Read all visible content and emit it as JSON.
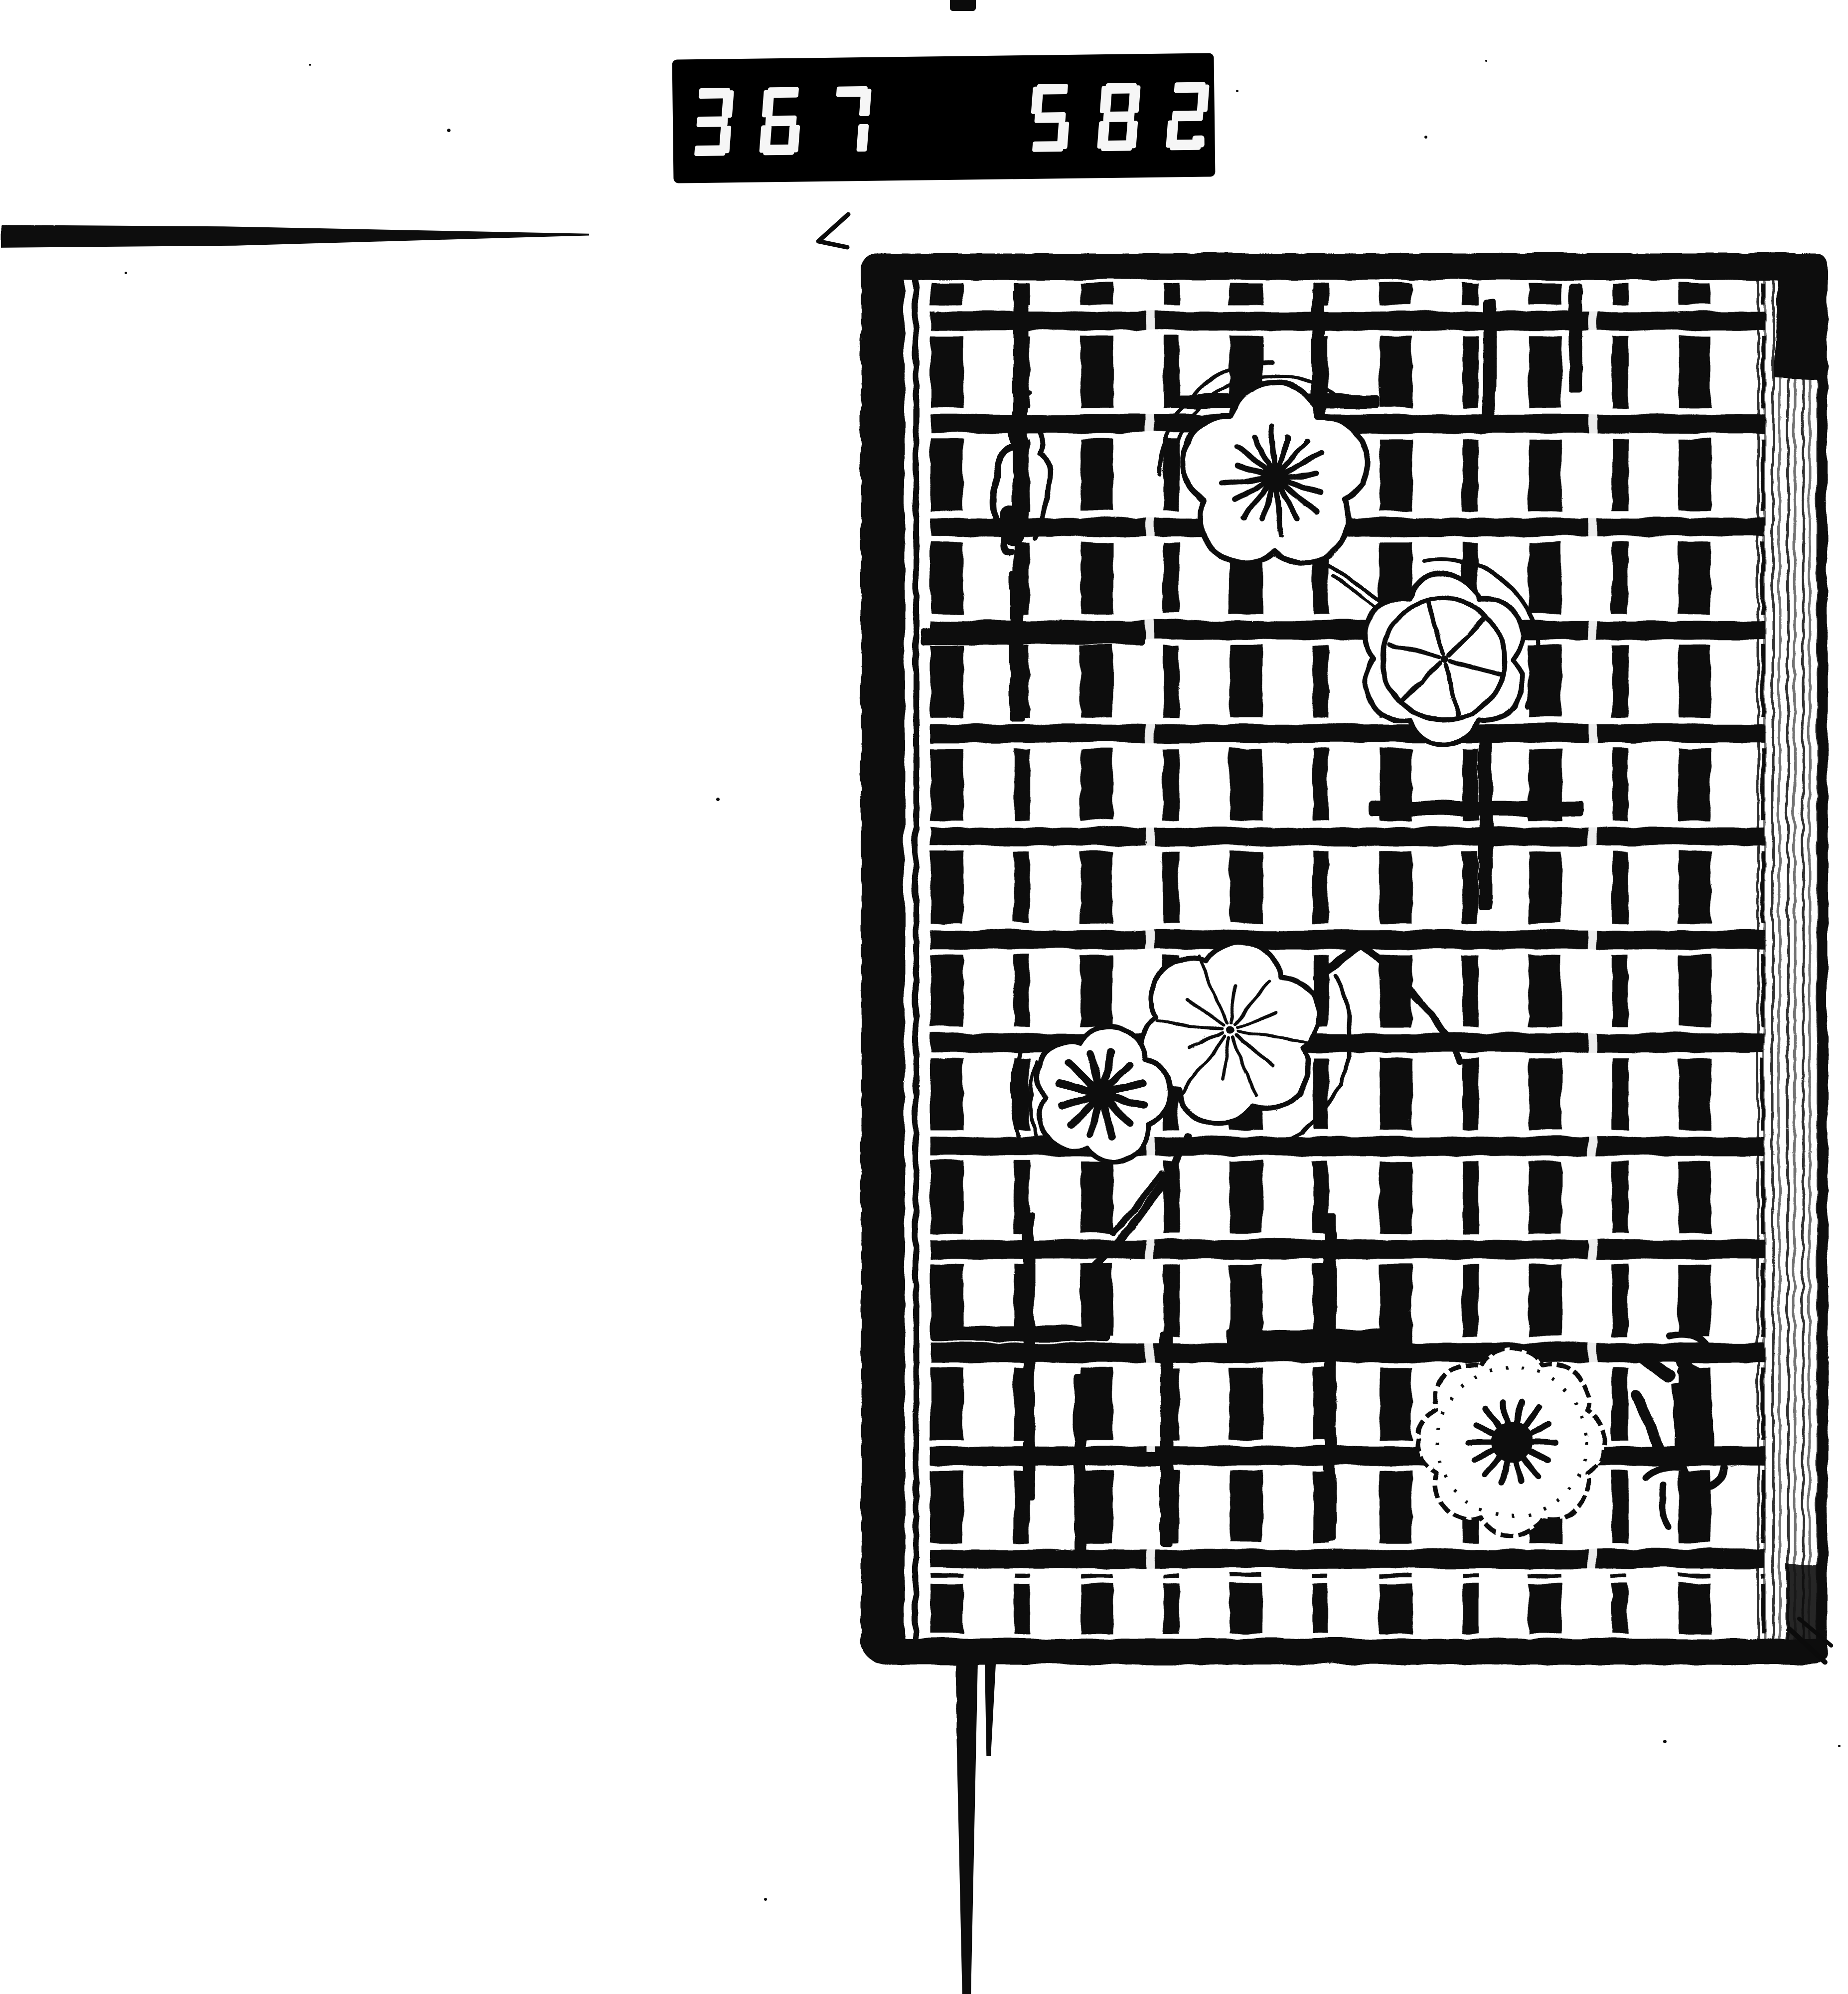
{
  "counter": {
    "group1": "367",
    "group2": "582",
    "decimal_point": ".",
    "display_style": "seven-segment"
  },
  "colors": {
    "paper": "#ffffff",
    "ink": "#0b0b0b",
    "counter_background": "#000000",
    "counter_digits": "#f6f6f6"
  },
  "book_cover": {
    "motif": "lattice check pattern with plum blossoms",
    "blossom_count": 5,
    "has_signature_mark": true
  }
}
